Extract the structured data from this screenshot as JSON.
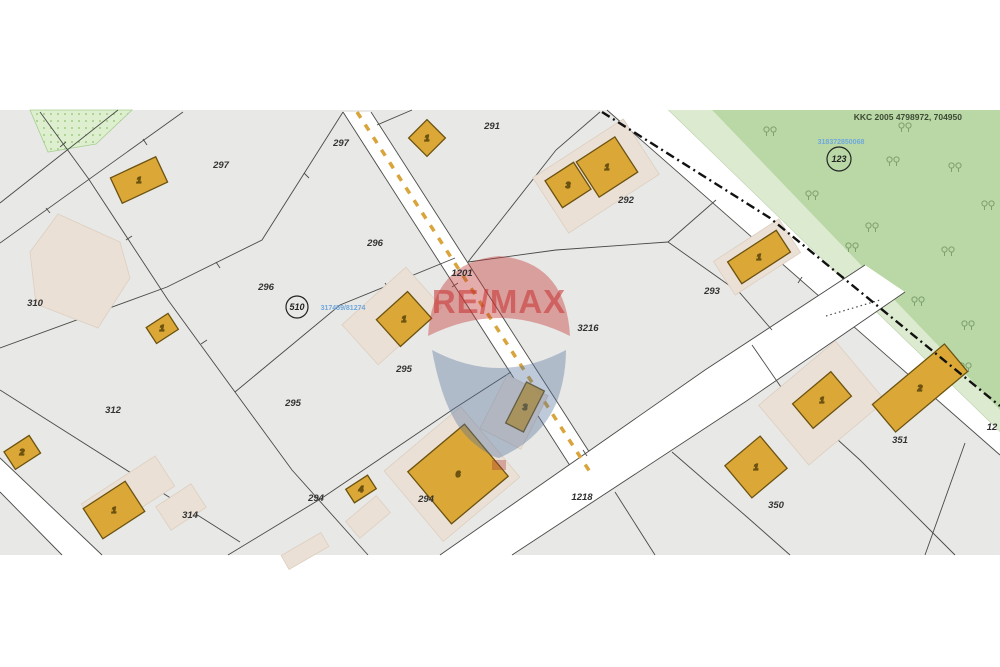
{
  "map": {
    "reference": "KKC 2005 4798972, 704950",
    "watermark": "RE/MAX",
    "parcel_labels": {
      "p297_left": "297",
      "p297_road": "297",
      "p291": "291",
      "p292": "292",
      "p293": "293",
      "p296_left": "296",
      "p296_mid": "296",
      "p310": "310",
      "p295_left": "295",
      "p295_mid": "295",
      "p294_junction": "294",
      "p294_mid": "294",
      "p312": "312",
      "p314": "314",
      "p350": "350",
      "p351": "351",
      "p3216": "3216",
      "p1201": "1201",
      "p1218": "1218",
      "p12_edge": "12"
    },
    "circled_labels": {
      "c510": "510",
      "c123": "123"
    },
    "blue_ids": {
      "center": "317459/81274",
      "forest": "318372850068"
    },
    "building_numbers": {
      "b1": "1",
      "b2": "1",
      "b3_small": "3",
      "b3_main": "1",
      "b4": "1",
      "b5": "1",
      "b6": "2",
      "b7": "1",
      "b8": "3",
      "b9": "6",
      "b10": "4",
      "b11": "2",
      "b12": "1",
      "b13": "1",
      "b14": "1"
    },
    "colors": {
      "parcel_fill": "#e8e8e6",
      "forest": "#b9d8a6",
      "forest_strip": "#dcebcf",
      "forest_dotted": "#ddefcf",
      "building": "#dba838",
      "halo": "#ebe0d5",
      "boundary": "#4a4a48",
      "road_centerline": "#d9a43b",
      "admin_line": "#111111",
      "blue_id": "#6fa8dc",
      "remax_red": "#c92f2f",
      "remax_blue": "#54719f",
      "reference_text": "#3c4a34"
    }
  }
}
